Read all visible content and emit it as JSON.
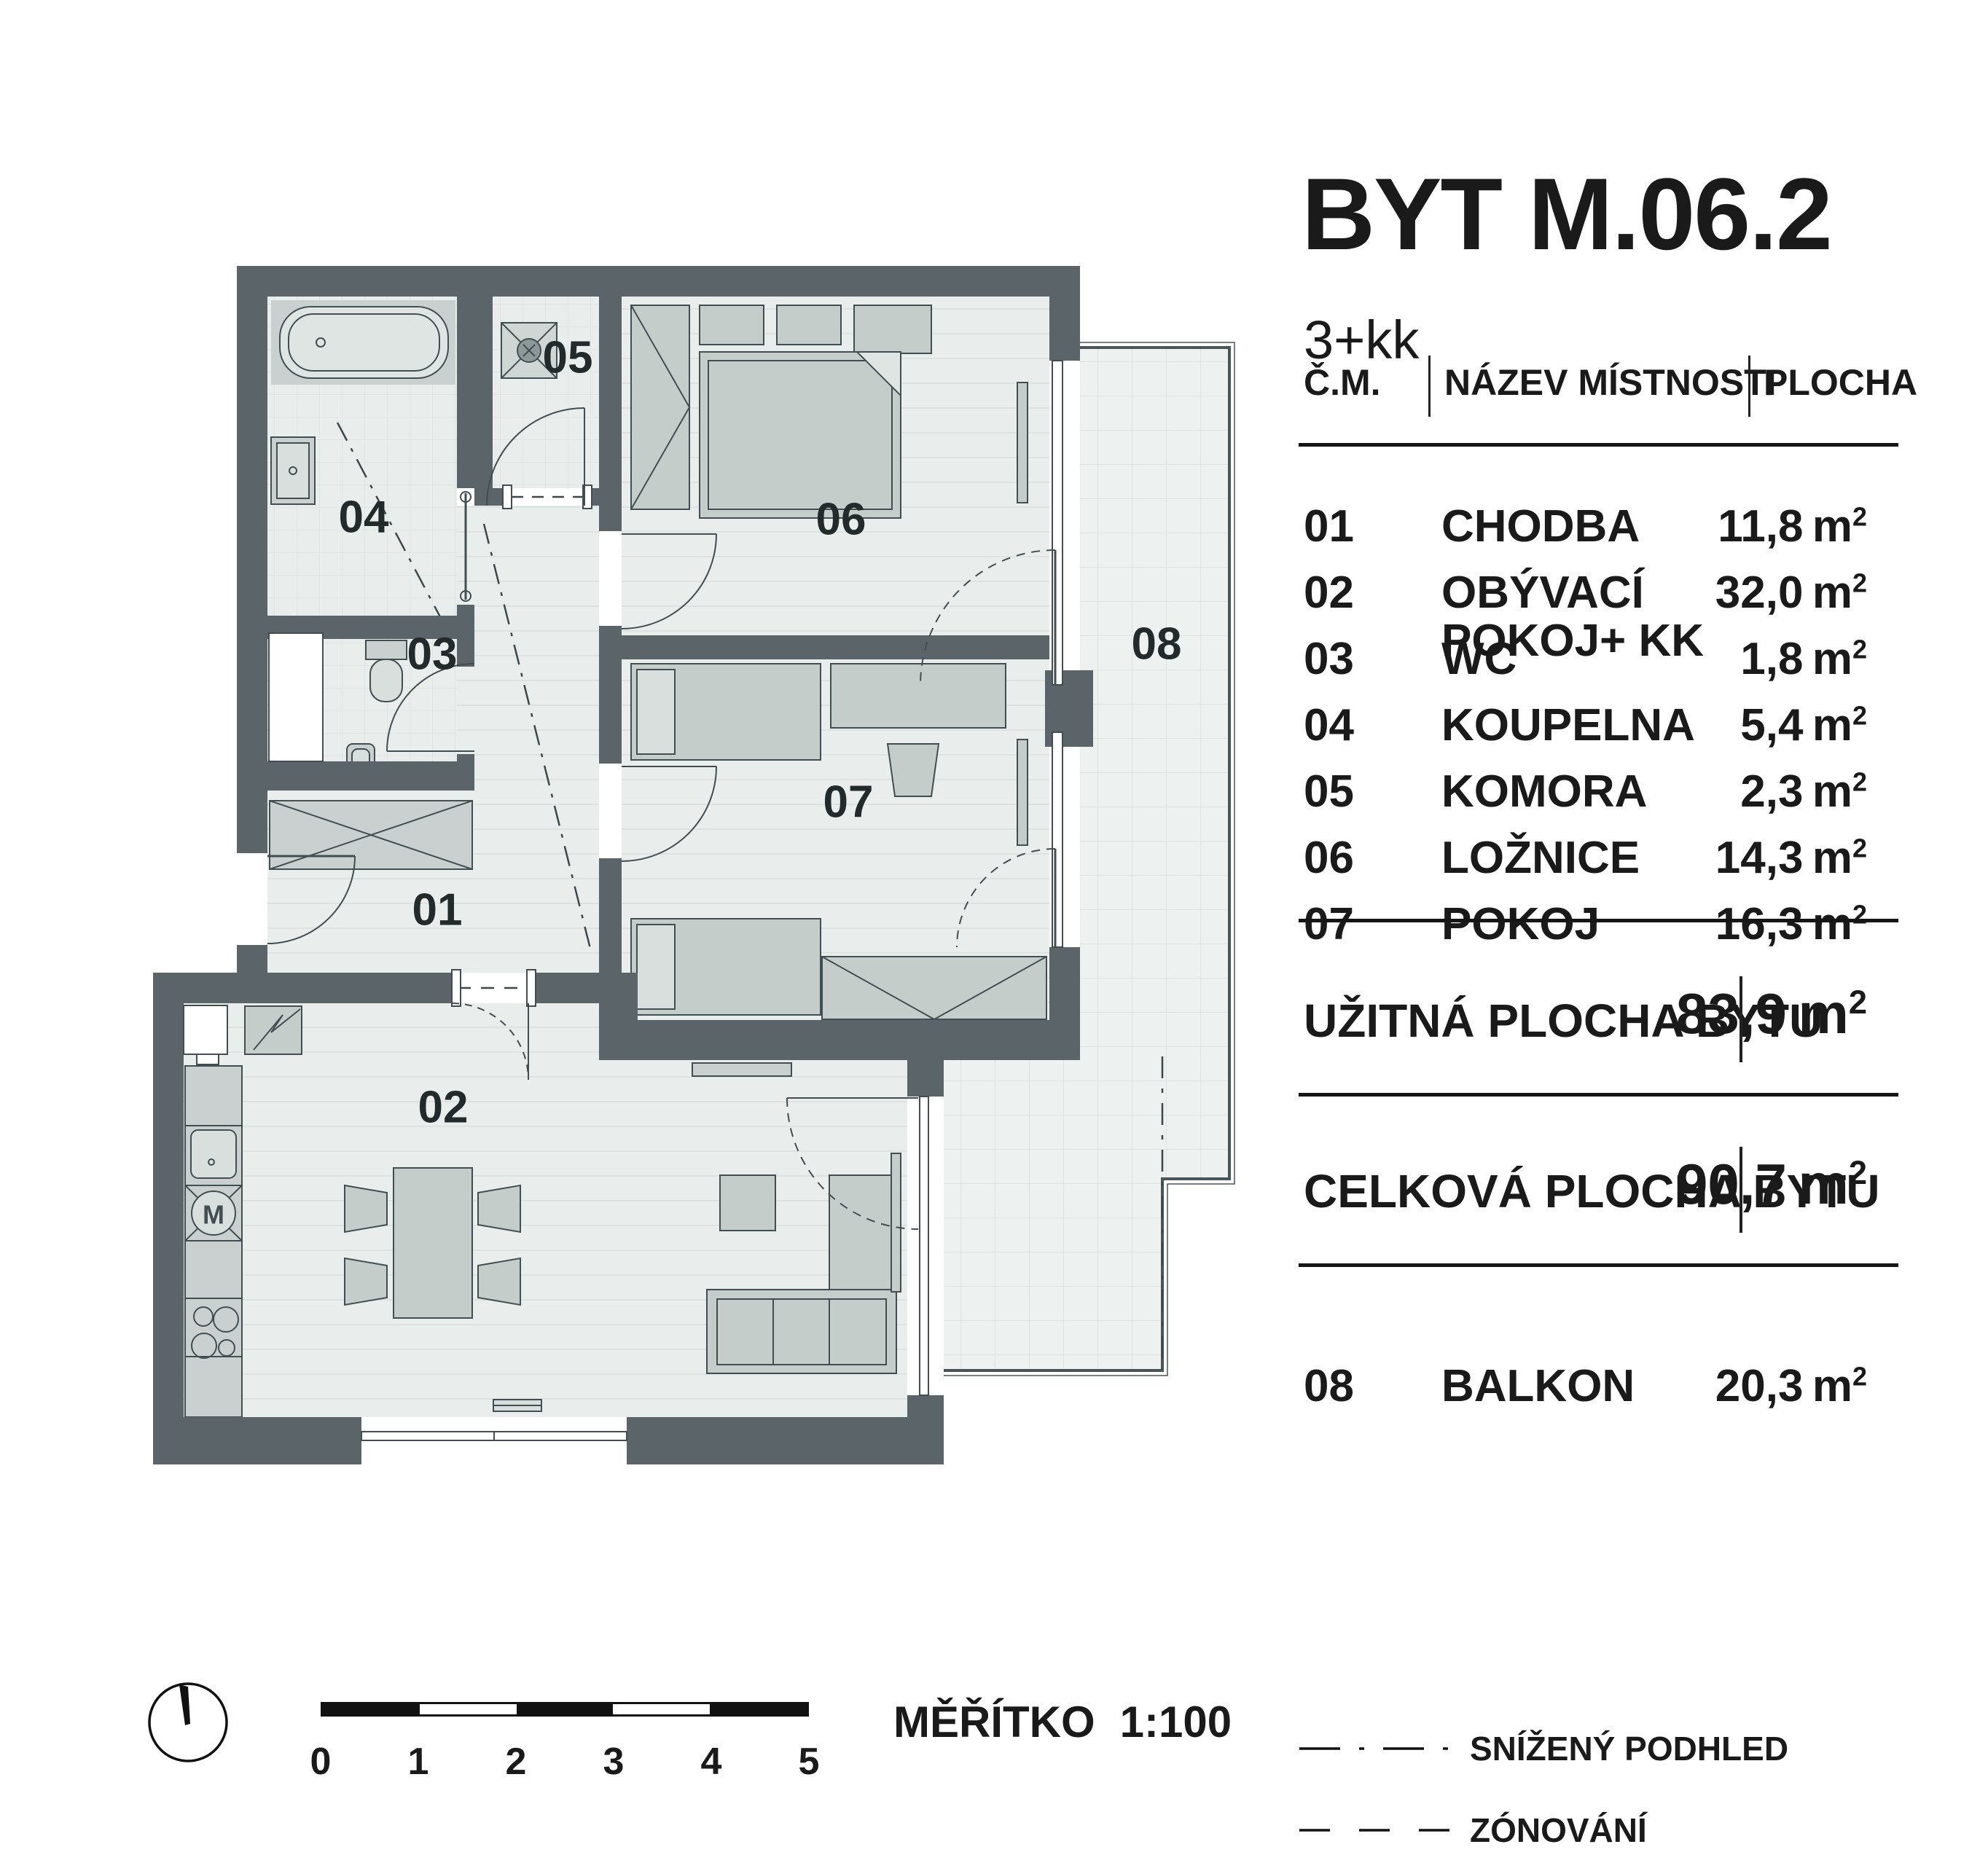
{
  "title": "BYT M.06.2",
  "subtitle": "3+kk",
  "table": {
    "headers": {
      "num": "Č.M.",
      "name": "NÁZEV MÍSTNOSTI",
      "area": "PLOCHA"
    },
    "rows": [
      {
        "num": "01",
        "name": "CHODBA",
        "area": "11,8"
      },
      {
        "num": "02",
        "name": "OBÝVACÍ POKOJ+ KK",
        "area": "32,0"
      },
      {
        "num": "03",
        "name": "WC",
        "area": "1,8"
      },
      {
        "num": "04",
        "name": "KOUPELNA",
        "area": "5,4"
      },
      {
        "num": "05",
        "name": "KOMORA",
        "area": "2,3"
      },
      {
        "num": "06",
        "name": "LOŽNICE",
        "area": "14,3"
      },
      {
        "num": "07",
        "name": "POKOJ",
        "area": "16,3"
      }
    ],
    "totals": [
      {
        "label": "UŽITNÁ PLOCHA BYTU",
        "value": "83,9"
      },
      {
        "label": "CELKOVÁ PLOCHA BYTU",
        "value": "90,7"
      }
    ],
    "balcony_row": {
      "num": "08",
      "name": "BALKON",
      "area": "20,3"
    }
  },
  "units": {
    "m": "m",
    "sup": "2"
  },
  "plan": {
    "labels": {
      "r01": "01",
      "r02": "02",
      "r03": "03",
      "r04": "04",
      "r05": "05",
      "r06": "06",
      "r07": "07",
      "r08": "08"
    },
    "washer_label": "M"
  },
  "scalebar": {
    "ticks": [
      "0",
      "1",
      "2",
      "3",
      "4",
      "5"
    ]
  },
  "scale_note": {
    "label": "MĚŘÍTKO",
    "value": "1:100"
  },
  "legend": [
    {
      "label": "SNÍŽENÝ PODHLED"
    },
    {
      "label": "ZÓNOVÁNÍ"
    }
  ],
  "colors": {
    "wall": "#5b6569",
    "floor": "#e9edeb",
    "furniture": "#c5cdcb",
    "balcony_grid": "#d8dfdd",
    "line": "#3d484b"
  }
}
